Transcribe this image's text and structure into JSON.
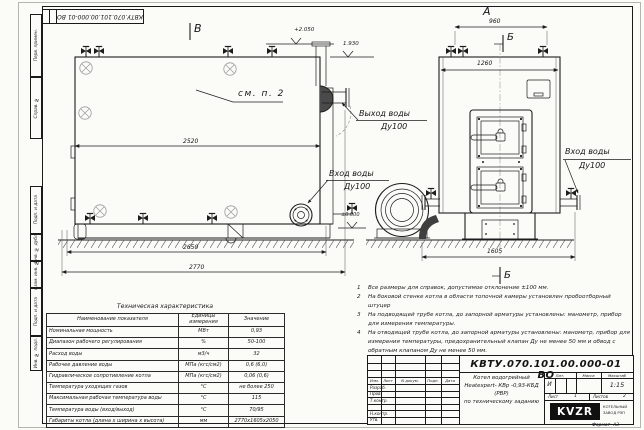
{
  "doc": {
    "number": "КВТУ.070.101.00.000-01 ВО"
  },
  "margins": {
    "labels": [
      "Перв. примен.",
      "Справ. №",
      "Подп. и дата",
      "Инв. № дубл.",
      "Взам. инв. №",
      "Подп. и дата",
      "Инв. № подл."
    ],
    "format_label": "Формат",
    "format_value": "А3"
  },
  "views": {
    "top_view": "В",
    "front_view": "А",
    "section_top": "Б",
    "section_bottom": "Б",
    "see_note": "см. п. 2"
  },
  "elevations": {
    "top": "+2.050",
    "mid": "1.930",
    "zero": "±0.000"
  },
  "dimensions": {
    "length_body": "2520",
    "length_base": "2650",
    "length_total": "2770",
    "front_top": "960",
    "front_width": "1260",
    "front_total": "1605"
  },
  "pipe_labels": {
    "outlet": "Выход воды",
    "outlet_dn": "Ду100",
    "inlet_side": "Вход воды",
    "inlet_side_dn": "Ду100",
    "inlet_right": "Вход воды",
    "inlet_right_dn": "Ду100"
  },
  "notes": {
    "items": [
      {
        "num": "1",
        "text": "Все размеры для справок, допустимое отклонение ±100 мм."
      },
      {
        "num": "2",
        "text": "На боковой стенке котла в области топочной камеры установлен пробоотборный штуцер"
      },
      {
        "num": "3",
        "text": "На подводящей трубе котла, до запорной арматуры установлены: манометр, прибор для измерения температуры."
      },
      {
        "num": "4",
        "text": "На отводящей трубе котла, до запорной арматуры установлены: манометр, прибор для измерения температуры, предохранительный клапан Ду не менее 50 мм и обвод с обратным клапаном Ду не менее 50 мм."
      }
    ]
  },
  "spec": {
    "title": "Техническая характеристика",
    "col_name": "Наименование показателя",
    "col_unit": "Единицы измерения",
    "col_value": "Значение",
    "rows": [
      {
        "name": "Номинальная мощность",
        "unit": "МВт",
        "value": "0,93"
      },
      {
        "name": "Диапазон рабочего регулирования",
        "unit": "%",
        "value": "50-100"
      },
      {
        "name": "Расход воды",
        "unit": "м3/ч",
        "value": "32"
      },
      {
        "name": "Рабочее давление воды",
        "unit": "МПа (кгс/см2)",
        "value": "0,6 (6,0)"
      },
      {
        "name": "Гидравлическое сопротивление котла",
        "unit": "МПа (кгс/см2)",
        "value": "0,06 (0,6)"
      },
      {
        "name": "Температура уходящих газов",
        "unit": "°С",
        "value": "не более 250"
      },
      {
        "name": "Максимальная рабочая температура воды",
        "unit": "°С",
        "value": "115"
      },
      {
        "name": "Температура воды (вход/выход)",
        "unit": "°С",
        "value": "70/95"
      },
      {
        "name": "Габариты котла (длина х ширина х высота)",
        "unit": "мм",
        "value": "2770х1605х2050"
      }
    ]
  },
  "stamp": {
    "rev_cols": {
      "izm": "Изм.",
      "list": "Лист",
      "doc": "N докум.",
      "sign": "Подп.",
      "date": "Дата"
    },
    "roles": [
      "Разраб.",
      "Пров.",
      "Т.контр.",
      "Н.контр.",
      "Утв."
    ],
    "title1": "Котел водогрейный",
    "title2": "Heatexpert- КВр -0,93-КБД (РВР)",
    "title3": "по техническому заданию",
    "lit_label": "Лит.",
    "lit": "И",
    "mass_label": "Масса",
    "scale_label": "Масштаб",
    "scale": "1:15",
    "sheet_label": "Лист",
    "sheet": "1",
    "sheets_label": "Листов",
    "sheets": "2",
    "logo": "KVZR",
    "company1": "КОТЕЛЬНЫЙ",
    "company2": "ЗАВОД РЭП"
  }
}
